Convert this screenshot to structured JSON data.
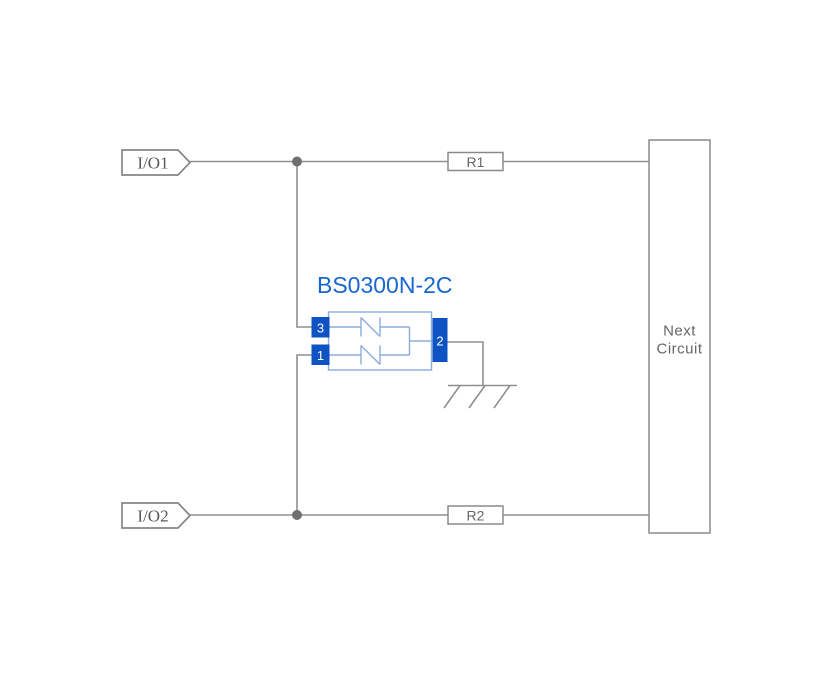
{
  "diagram": {
    "kind": "esd-protection-application-circuit",
    "component": {
      "title": "BS0300N-2C",
      "pins": [
        {
          "number": "3",
          "position": "left-top"
        },
        {
          "number": "1",
          "position": "left-bottom"
        },
        {
          "number": "2",
          "position": "right"
        }
      ],
      "internal_elements": [
        "bidirectional-suppressor-top",
        "bidirectional-suppressor-bottom"
      ]
    },
    "ports": [
      {
        "label": "I/O1"
      },
      {
        "label": "I/O2"
      }
    ],
    "resistors": [
      {
        "label": "R1"
      },
      {
        "label": "R2"
      }
    ],
    "next_circuit": {
      "line1": "Next",
      "line2": "Circuit"
    },
    "ground": {
      "symbol": "chassis-ground"
    },
    "colors": {
      "background": "#ffffff",
      "wire_gray": "#8f8f8f",
      "junction_gray": "#6f6f6f",
      "outline_gray": "#8a8a8a",
      "label_gray": "#666666",
      "component_pin_blue": "#0e52c4",
      "component_body_blue": "#8aadde",
      "title_blue": "#1766d1"
    }
  }
}
